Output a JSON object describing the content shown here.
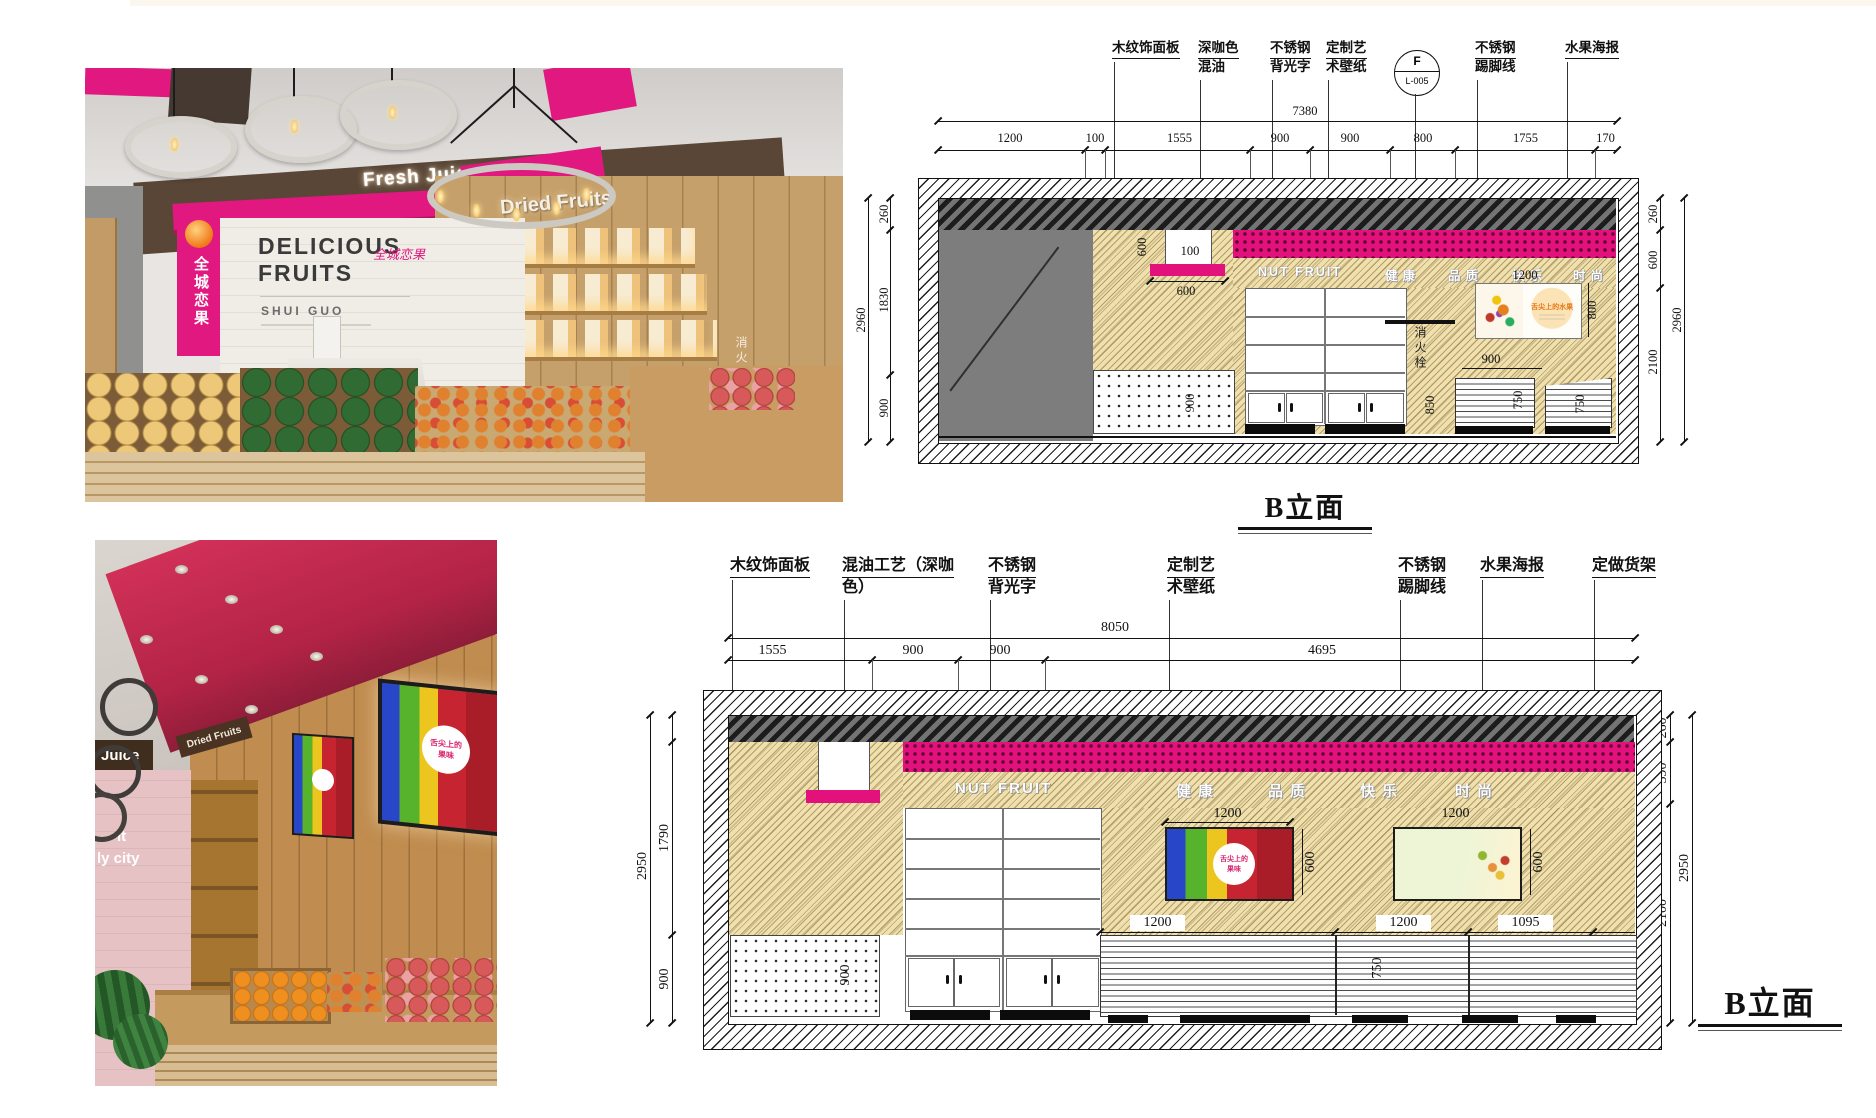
{
  "sheet": {
    "note": ""
  },
  "photo_top": {
    "sign_fresh_juice": "Fresh Juice",
    "sign_dried_fruits": "Dried Fruits",
    "wall_line1": "DELICIOUS",
    "wall_line2": "FRUITS",
    "wall_script": "全城恋果",
    "wall_sub": "SHUI GUO",
    "pillar_text": "全城恋果",
    "hydrant_text": "消火栓"
  },
  "photo_bottom": {
    "sign_juice": "Juice",
    "sign_dried_fruits": "Dried Fruits",
    "wall_text_line1": "it",
    "wall_text_line2": "ly city",
    "poster_line1": "舌尖上的",
    "poster_line2": "果味"
  },
  "elev_top": {
    "title": "B立面",
    "sign": "NUT FRUIT",
    "slogan": [
      "健康",
      "品质",
      "快乐",
      "时尚"
    ],
    "hydrant": "消火栓",
    "poster_title": "舌尖上的水果",
    "tag": {
      "line1": "F",
      "line2": "L-005"
    },
    "callouts": {
      "c1": "木纹饰面板",
      "c2a": "深咖色",
      "c2b": "混油",
      "c3a": "不锈钢",
      "c3b": "背光字",
      "c4a": "定制艺",
      "c4b": "术壁纸",
      "c5a": "不锈钢",
      "c5b": "踢脚线",
      "c6": "水果海报"
    },
    "dims": {
      "total": "7380",
      "w": [
        "1200",
        "100",
        "1555",
        "900",
        "900",
        "800",
        "1755",
        "170"
      ],
      "left_total": "2960",
      "left": [
        "260",
        "1830",
        "900"
      ],
      "right": [
        "260",
        "600",
        "2100"
      ],
      "right_total": "2960",
      "recess_h": "600",
      "recess_w": "100",
      "plate_w": "600",
      "peg_h": "900",
      "poster_w": "1200",
      "poster_h": "800",
      "below_poster": "900",
      "hydrant_h": "850",
      "shelf_a": "750",
      "shelf_b": "750"
    }
  },
  "elev_bottom": {
    "title": "B立面",
    "sign": "NUT FRUIT",
    "slogan": [
      "健康",
      "品质",
      "快乐",
      "时尚"
    ],
    "callouts": {
      "c1": "木纹饰面板",
      "c2a": "混油工艺（深咖",
      "c2b": "色）",
      "c3a": "不锈钢",
      "c3b": "背光字",
      "c4a": "定制艺",
      "c4b": "术壁纸",
      "c5a": "不锈钢",
      "c5b": "踢脚线",
      "c6": "水果海报",
      "c7": "定做货架"
    },
    "dims": {
      "total": "8050",
      "w": [
        "1555",
        "900",
        "900",
        "4695"
      ],
      "left_total": "2950",
      "left": [
        "1790",
        "900"
      ],
      "right": [
        "260",
        "590",
        "2100"
      ],
      "right_total": "2950",
      "peg_h": "900",
      "poster1_w": "1200",
      "poster1_h": "600",
      "poster2_w": "1200",
      "poster2_h": "600",
      "shelf_w": [
        "1200",
        "1200",
        "1095"
      ],
      "shelf_h": "750"
    }
  }
}
